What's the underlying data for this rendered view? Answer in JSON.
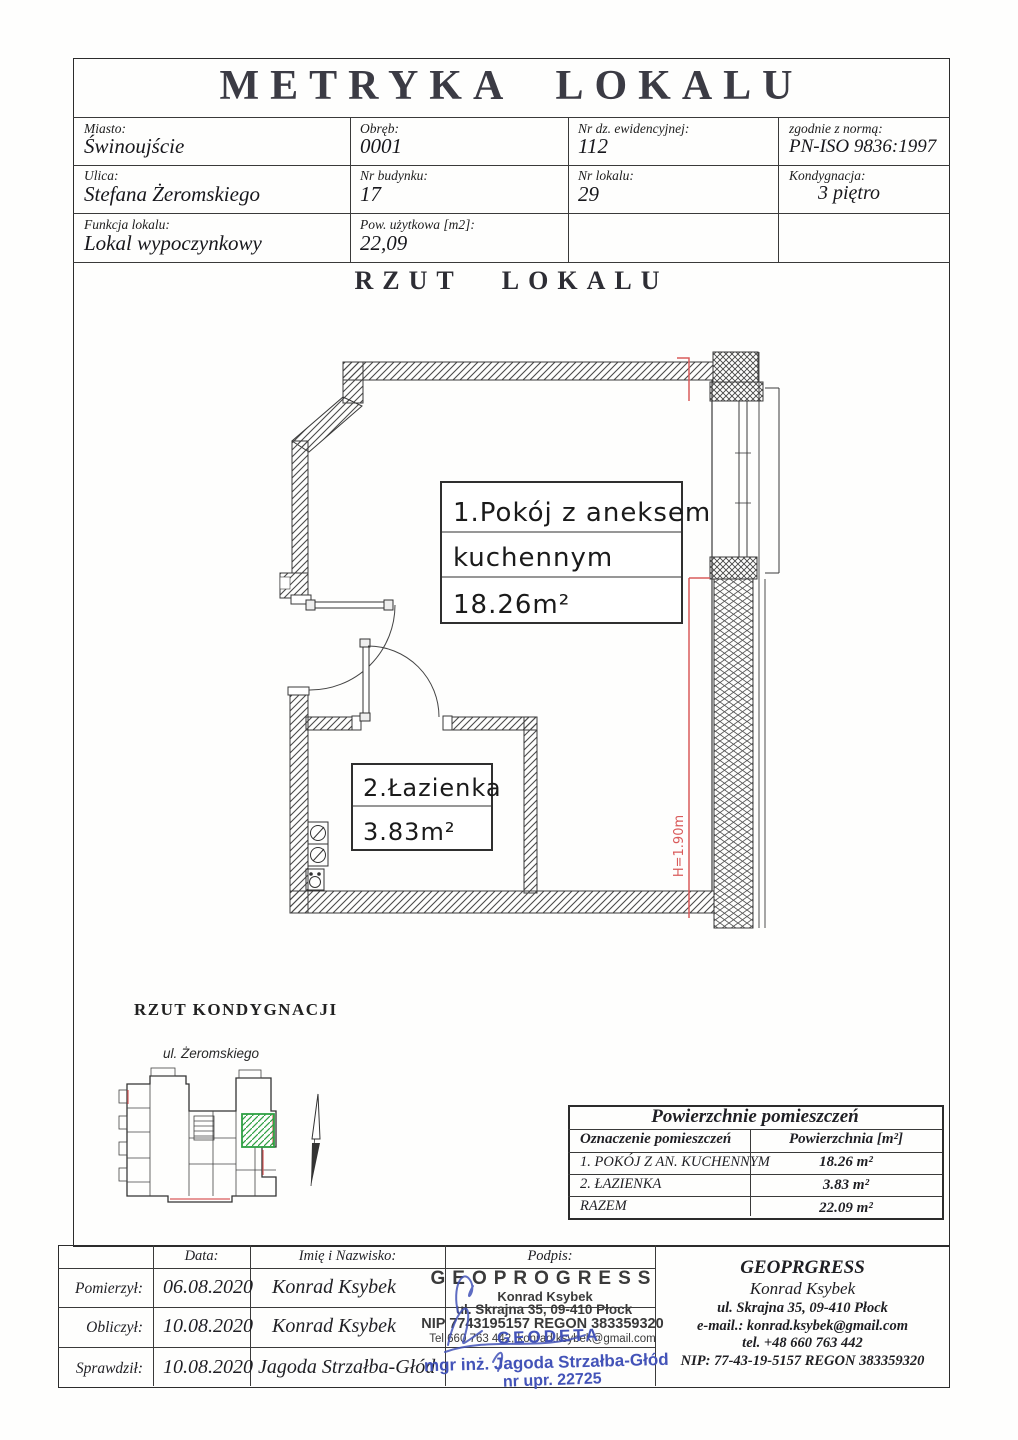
{
  "header": {
    "title": "METRYKA LOKALU",
    "fields": [
      {
        "label": "Miasto:",
        "value": "Świnoujście"
      },
      {
        "label": "Obręb:",
        "value": "0001"
      },
      {
        "label": "Nr dz. ewidencyjnej:",
        "value": "112"
      },
      {
        "label": "zgodnie z normą:",
        "value": "PN-ISO 9836:1997"
      },
      {
        "label": "Ulica:",
        "value": "Stefana Żeromskiego"
      },
      {
        "label": "Nr budynku:",
        "value": "17"
      },
      {
        "label": "Nr lokalu:",
        "value": "29"
      },
      {
        "label": "Kondygnacja:",
        "value": "3 piętro"
      },
      {
        "label": "Funkcja lokalu:",
        "value": "Lokal wypoczynkowy"
      },
      {
        "label": "Pow. użytkowa [m2]:",
        "value": "22,09"
      }
    ]
  },
  "plan": {
    "section_title": "RZUT LOKALU",
    "room1_line1": "1.Pokój z aneksem",
    "room1_line2": "kuchennym",
    "room1_area": "18.26m²",
    "room2_name": "2.Łazienka",
    "room2_area": "3.83m²",
    "height_note": "H=1.90m"
  },
  "floor_section": {
    "title": "RZUT KONDYGNACJI",
    "street": "ul. Żeromskiego"
  },
  "area_table": {
    "title": "Powierzchnie pomieszczeń",
    "col1": "Oznaczenie pomieszczeń",
    "col2": "Powierzchnia [m²]",
    "rows": [
      {
        "name": "1. POKÓJ Z AN. KUCHENNYM",
        "area": "18.26 m²"
      },
      {
        "name": "2. ŁAZIENKA",
        "area": "3.83 m²"
      },
      {
        "name": "RAZEM",
        "area": "22.09 m²"
      }
    ]
  },
  "footer": {
    "headers": {
      "data": "Data:",
      "name": "Imię i Nazwisko:",
      "sign": "Podpis:"
    },
    "rows": [
      {
        "label": "Pomierzył:",
        "date": "06.08.2020",
        "name": "Konrad Ksybek"
      },
      {
        "label": "Obliczył:",
        "date": "10.08.2020",
        "name": "Konrad Ksybek"
      },
      {
        "label": "Sprawdził:",
        "date": "10.08.2020",
        "name": "Jagoda Strzałba-Głód"
      }
    ],
    "stamp_black": {
      "line1": "GEOPROGRESS",
      "line2": "Konrad Ksybek",
      "line3": "ul. Skrajna 35, 09-410 Płock",
      "line4": "NIP 7743195157  REGON 383359320",
      "line5": "Tel 660 763 442, konrad.ksybek@gmail.com"
    },
    "stamp_blue": {
      "line1": "GEODETA",
      "line2": "mgr inż. Jagoda Strzałba-Głód",
      "line3": "nr upr. 22725"
    },
    "company_box": {
      "line1": "GEOPRGRESS",
      "line2": "Konrad Ksybek",
      "line3": "ul. Skrajna 35, 09-410 Płock",
      "line4": "e-mail.: konrad.ksybek@gmail.com",
      "line5": "tel. +48 660 763 442",
      "line6": "NIP:  77-43-19-5157 REGON 383359320"
    }
  },
  "colors": {
    "line": "#3a3a3a",
    "red_accent": "#d95b5b",
    "green_unit": "#2ea043",
    "blue_stamp": "#4353b8"
  }
}
